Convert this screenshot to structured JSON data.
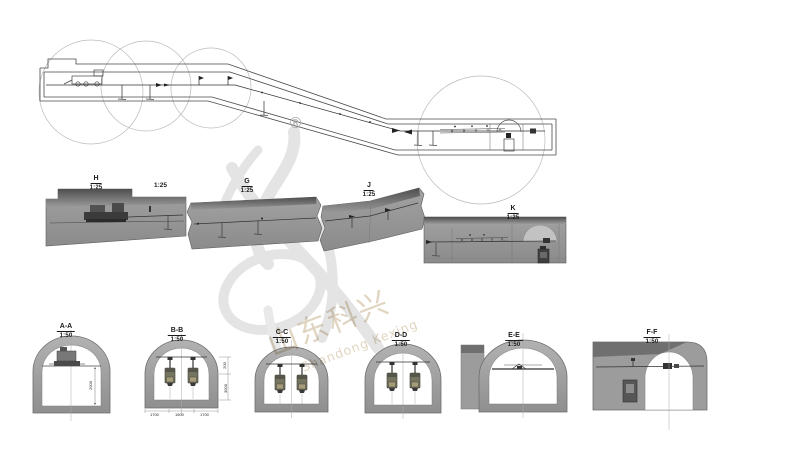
{
  "watermark": {
    "registered": "®",
    "cn_text": "山东科兴",
    "en_text": "Shandong Kexing"
  },
  "sections": {
    "h": {
      "label": "H",
      "scale": "1:25"
    },
    "h_extra_scale": "1:25",
    "g": {
      "label": "G",
      "scale": "1:25"
    },
    "j": {
      "label": "J",
      "scale": "1:25"
    },
    "k": {
      "label": "K",
      "scale": "1:25"
    }
  },
  "cross_sections": {
    "aa": {
      "label": "A-A",
      "scale": "1:50"
    },
    "bb": {
      "label": "B-B",
      "scale": "1:50"
    },
    "cc": {
      "label": "C-C",
      "scale": "1:50"
    },
    "dd": {
      "label": "D-D",
      "scale": "1:50"
    },
    "ee": {
      "label": "E-E",
      "scale": "1:50"
    },
    "ff": {
      "label": "F-F",
      "scale": "1:50"
    }
  },
  "dimensions": {
    "aa_height": "2000",
    "bb_right_upper": "200",
    "bb_right_lower": "3000",
    "bb_bottom": [
      "1700",
      "1500",
      "1700"
    ]
  },
  "colors": {
    "background": "#ffffff",
    "line": "#4a4a4a",
    "detail_circle": "#bbbbbb",
    "section_gray": "#9a9a9a",
    "section_dark": "#4e4e4e",
    "equipment_olive": "#75755f",
    "equipment_tan": "#a59c7a",
    "watermark_logo": "#e4e4e4",
    "watermark_text": "#d9cbb2"
  }
}
